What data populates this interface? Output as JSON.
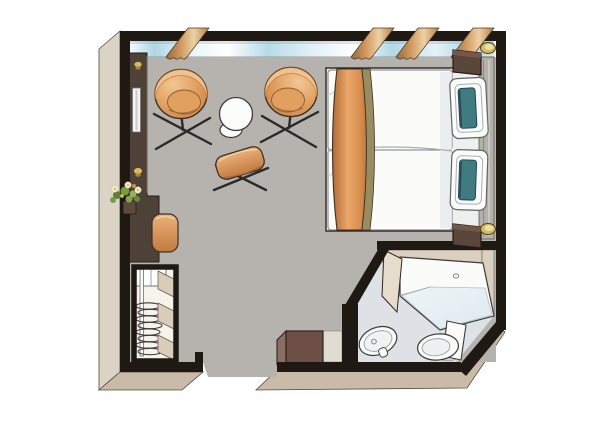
{
  "meta": {
    "description": "Cruise ship stateroom floor plan, top-down illustrated view",
    "rooms": [
      "cabin",
      "bathroom"
    ]
  },
  "colors": {
    "wall_black": "#1f1913",
    "exterior_face": "#dad3c6",
    "exterior_edge": "#554c42",
    "bottom_face": "#c9bba7",
    "floor": "#b6b3ae",
    "sill": "#83827e",
    "window_blue": "#aed6e6",
    "curtain_dark": "#9c6737",
    "curtain_light": "#ecd0a4",
    "wardrobe": "#4e4137",
    "closet_bg": "#f6f3ec",
    "shelf": "#d9cdba",
    "chair_tan": "#dc9356",
    "chair_light": "#f2c795",
    "chair_dark": "#c97f42",
    "outline": "#3c3025",
    "table_white": "#fcfcfb",
    "runner_dark": "#b06a33",
    "runner_light": "#eba76b",
    "khaki": "#998d60",
    "duvet": "#fbfbfa",
    "teal": "#3f7b81",
    "headboard": "#b4b1ac",
    "nightstand": "#5b463b",
    "lamp_gold": "#d5b95f",
    "bath_floor": "#dee2e6",
    "bath_wall": "#dbd0c0",
    "door": "#e6dccc",
    "glass": "#cfe2eb",
    "fixture_white": "#fbfbfa",
    "fixture_line": "#3b3b3b",
    "box_brown": "#6d4f47",
    "box_brown_light": "#8d6c61",
    "flower_green": "#7a9a44",
    "flower_white": "#f5f2e8",
    "flower_yellow": "#e8c83c"
  },
  "window_wall": {
    "panoramic_window": true,
    "curtain_count": 4
  },
  "objects": {
    "living_area": [
      "armchair-left",
      "armchair-right",
      "round-table",
      "ottoman",
      "vanity-desk",
      "stool",
      "flower-bouquet",
      "mirror",
      "wardrobe-strip",
      "closet-with-hangers"
    ],
    "sleeping_area": [
      "twin-bed-left",
      "twin-bed-right",
      "bed-runner",
      "pillow-top",
      "pillow-bottom",
      "headboard",
      "nightstand-top",
      "nightstand-bottom",
      "table-lamp-top",
      "table-lamp-bottom"
    ],
    "bathroom": [
      "shower-enclosure",
      "washbasin",
      "toilet",
      "bathroom-door",
      "storage-box"
    ]
  }
}
